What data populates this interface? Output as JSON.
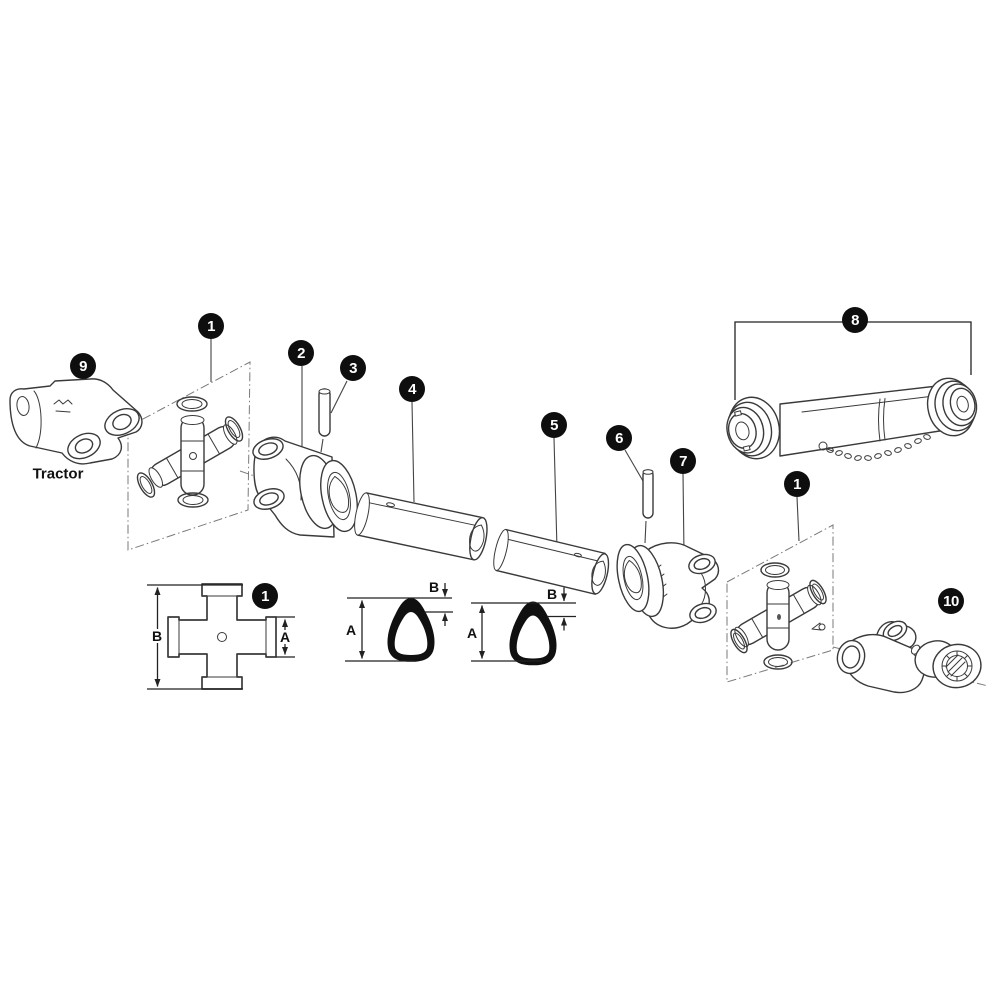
{
  "canvas": {
    "width": 1000,
    "height": 1000,
    "background": "#ffffff"
  },
  "colors": {
    "line": "#3a3a3a",
    "badge_background": "#0e0e0e",
    "badge_text": "#ffffff",
    "dimension_line": "#222222"
  },
  "labels": {
    "tractor": "Tractor"
  },
  "callouts": [
    {
      "number": "9"
    },
    {
      "number": "1"
    },
    {
      "number": "2"
    },
    {
      "number": "3"
    },
    {
      "number": "4"
    },
    {
      "number": "5"
    },
    {
      "number": "6"
    },
    {
      "number": "7"
    },
    {
      "number": "8"
    },
    {
      "number": "1"
    },
    {
      "number": "10"
    },
    {
      "number": "1"
    }
  ],
  "dimensions": {
    "cross_height": "B",
    "cross_cup": "A",
    "section1_height": "A",
    "section1_wall": "B",
    "section2_height": "A",
    "section2_wall": "B"
  }
}
